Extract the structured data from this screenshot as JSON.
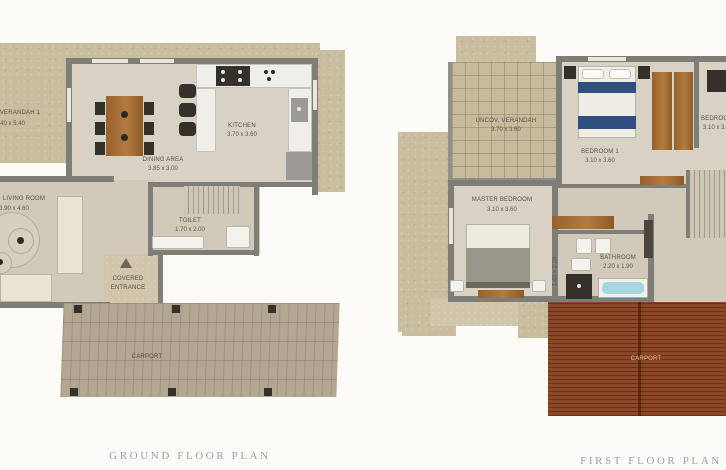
{
  "captions": {
    "ground": "GROUND FLOOR PLAN",
    "first": "FIRST FLOOR PLAN"
  },
  "ground_floor": {
    "verandah1": {
      "label": "VERANDAH 1",
      "dims": "1.40 x 5.40"
    },
    "dining": {
      "label": "DINING AREA",
      "dims": "3.85 x 3.00"
    },
    "kitchen": {
      "label": "KITCHEN",
      "dims": "3.70 x 3.60"
    },
    "living": {
      "label": "LIVING ROOM",
      "dims": "3.90 x 4.60"
    },
    "toilet": {
      "label": "TOILET",
      "dims": "1.70 x 2.00"
    },
    "entrance": {
      "line1": "COVERED",
      "line2": "ENTRANCE"
    },
    "carport": {
      "label": "CARPORT"
    }
  },
  "first_floor": {
    "verandah": {
      "label": "UNCOV. VERANDAH",
      "dims": "3.70 x 3.60"
    },
    "bedroom1": {
      "label": "BEDROOM 1",
      "dims": "3.10 x 3.60"
    },
    "bedroom2": {
      "label": "BEDROOM 2",
      "dims": "3.10 x 3.60"
    },
    "master": {
      "label": "MASTER BEDROOM",
      "dims": "3.10 x 3.60"
    },
    "bathroom": {
      "label": "BATHROOM",
      "dims": "2.20 x 1.90"
    },
    "hall_dims": "1.40 x 2.20",
    "carport": {
      "label": "CARPORT"
    }
  },
  "icons": {
    "entrance_arrow": "triangle-up"
  },
  "colors": {
    "wall": "#7f7d77",
    "floor": "#d8d2c4",
    "veranda_tan": "#c8bd9e",
    "carport_pavers": "#b2a791",
    "carport_roof": "#8c4727",
    "bed_blue": "#2e4f80",
    "bathtub_water": "#a8d4e0",
    "wood_furniture": "#a06a33",
    "caption_text": "#96a1b3"
  }
}
